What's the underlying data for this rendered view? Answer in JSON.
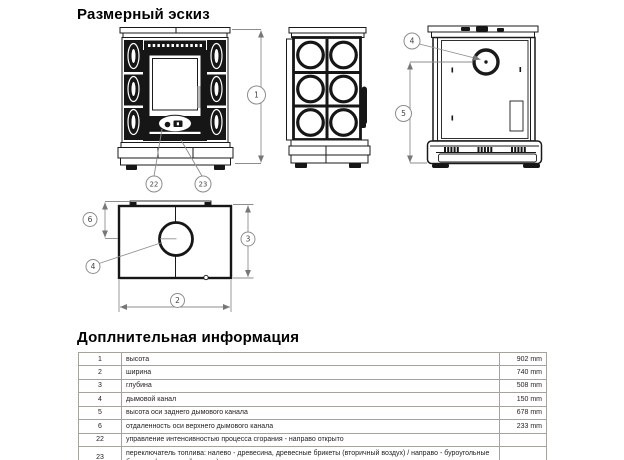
{
  "page": {
    "title_top": "Размерный эскиз",
    "title_bottom": "Доплнительная информация"
  },
  "drawing": {
    "labels": {
      "d1": "1",
      "d2": "2",
      "d3": "3",
      "d4": "4",
      "d5": "5",
      "d6": "6",
      "c22": "22",
      "c23": "23"
    }
  },
  "table": {
    "rows": [
      {
        "num": "1",
        "desc": "высота",
        "value": "902 mm"
      },
      {
        "num": "2",
        "desc": "ширина",
        "value": "740 mm"
      },
      {
        "num": "3",
        "desc": "глубина",
        "value": "508 mm"
      },
      {
        "num": "4",
        "desc": "дымовой канал",
        "value": "150 mm"
      },
      {
        "num": "5",
        "desc": "высота оси заднего дымового канала",
        "value": "678 mm"
      },
      {
        "num": "6",
        "desc": "отдаленность оси верхнего дымового канала",
        "value": "233 mm"
      },
      {
        "num": "22",
        "desc": "управление интенсивностью процесса сгорания - направо открыто",
        "value": ""
      },
      {
        "num": "23",
        "desc": "переключатель топлива: налево - древесина, древесные брикеты (вторичный воздух) / направо - буроугольные брикеты (первичный воздух)",
        "value": ""
      }
    ]
  },
  "colors": {
    "ink": "#1a1a1a",
    "dim_line": "#8d8d8d"
  }
}
